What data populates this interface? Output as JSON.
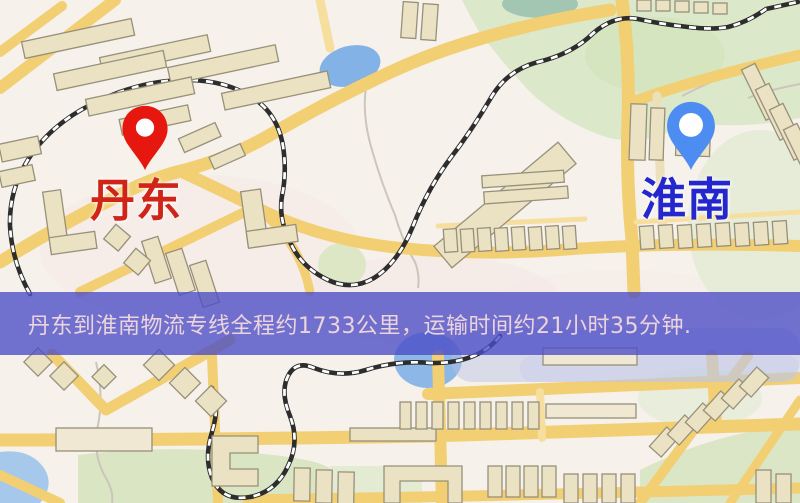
{
  "map": {
    "markers": [
      {
        "city": "丹东",
        "icon": "red-location-pin-icon",
        "pin_color": "#e5170e",
        "label_color": "#cf2417"
      },
      {
        "city": "淮南",
        "icon": "blue-location-pin-icon",
        "pin_color": "#4d8df2",
        "label_color": "#2427cd"
      }
    ],
    "palette": {
      "background": "#f6f1ea",
      "road": "#f2cf72",
      "park": "#dce8ca",
      "water": "#8db7e6",
      "railway": "#2d2d2d",
      "building": "#ebe1c3"
    }
  },
  "banner": {
    "text": "丹东到淮南物流专线全程约1733公里，运输时间约21小时35分钟.",
    "background_color": "rgba(74,75,198,0.78)",
    "text_color": "#ecd4dc",
    "distance_text": "约1733公里",
    "duration_text": "约21小时35分钟"
  }
}
